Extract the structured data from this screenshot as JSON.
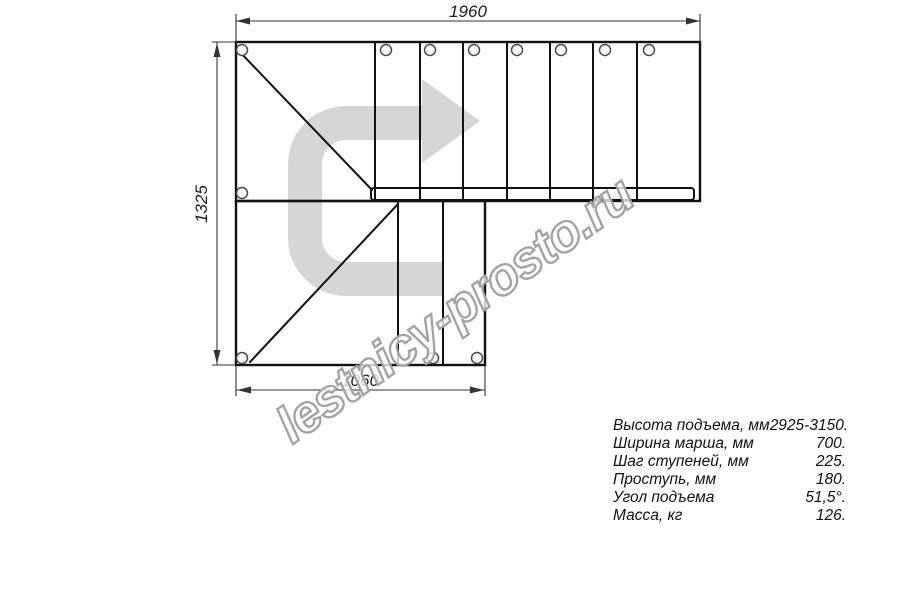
{
  "drawing": {
    "type": "staircase-floor-plan",
    "dimension_labels": {
      "overall_width_mm": "1960",
      "overall_depth_mm": "1325",
      "lower_width_mm": "1060"
    },
    "colors": {
      "line": "#111111",
      "dimension_line": "#333333",
      "direction_arrow_fill": "#d6d6d6",
      "watermark_outline": "#a2a2a2"
    },
    "icons": {
      "direction_arrow": "u-turn-right-direction-arrow"
    }
  },
  "watermark": {
    "text": "lestnicy-prosto.ru"
  },
  "specs": {
    "rows": [
      {
        "label": "Высота подъема, мм",
        "value": "2925-3150."
      },
      {
        "label": "Ширина марша, мм",
        "value": "700."
      },
      {
        "label": "Шаг ступеней, мм",
        "value": "225."
      },
      {
        "label": "Проступь, мм",
        "value": "180."
      },
      {
        "label": "Угол подъема",
        "value": "51,5°."
      },
      {
        "label": "Масса, кг",
        "value": "126."
      }
    ]
  }
}
